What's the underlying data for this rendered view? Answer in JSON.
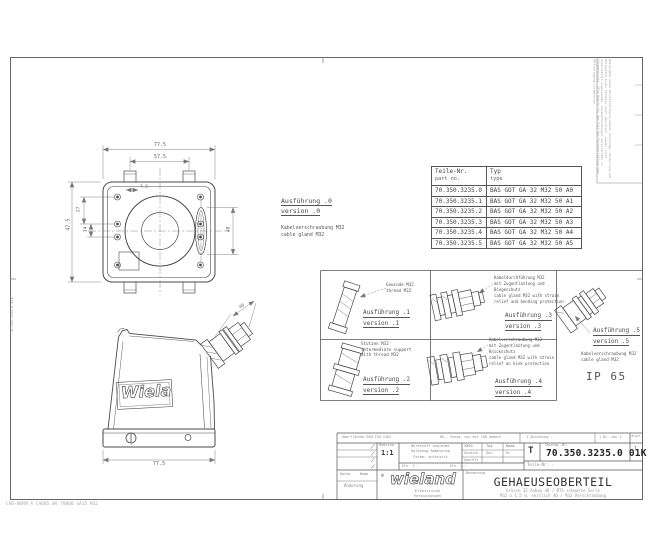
{
  "parts_table": {
    "header": {
      "part_no_de": "Teile-Nr.",
      "part_no_en": "part no.",
      "type_de": "Typ",
      "type_en": "type"
    },
    "rows": [
      {
        "part_no": "70.350.3235.0",
        "type": "BAS GOT GA 32 M32 50 A0"
      },
      {
        "part_no": "70.350.3235.1",
        "type": "BAS GOT GA 32 M32 50 A1"
      },
      {
        "part_no": "70.350.3235.2",
        "type": "BAS GOT GA 32 M32 50 A2"
      },
      {
        "part_no": "70.350.3235.3",
        "type": "BAS GOT GA 32 M32 50 A3"
      },
      {
        "part_no": "70.350.3235.4",
        "type": "BAS GOT GA 32 M32 50 A4"
      },
      {
        "part_no": "70.350.3235.5",
        "type": "BAS GOT GA 32 M32 50 A5"
      }
    ]
  },
  "versions": {
    "v0": {
      "title": "Ausführung .0",
      "subtitle": "version .0",
      "note1": "Kabelverschraubung M32",
      "note2": "cable gland M32"
    },
    "v1": {
      "title": "Ausführung .1",
      "subtitle": "version .1",
      "note1": "Gewinde M32",
      "note2": "thread M32"
    },
    "v2": {
      "title": "Ausführung .2",
      "subtitle": "version .2",
      "note1": "Stutzen M32",
      "note2": "intermediate support",
      "note3": "with thread M32"
    },
    "v3": {
      "title": "Ausführung .3",
      "subtitle": "version .3",
      "note1": "Kabeldurchführung M32",
      "note2": "mit Zugentlastung und",
      "note3": "Biegeschutz",
      "note4": "cable gland M32 with strain",
      "note5": "relief and bending protection"
    },
    "v4": {
      "title": "Ausführung .4",
      "subtitle": "version .4",
      "note1": "Kabelverschraubung M32",
      "note2": "mit Zugentlastung und",
      "note3": "Knickschutz",
      "note4": "cable gland M32 with strain",
      "note5": "relief an kink protection"
    },
    "v5": {
      "title": "Ausführung .5",
      "subtitle": "version .5",
      "note1": "Kabelverschraubung M32",
      "note2": "cable gland M32"
    }
  },
  "ip_rating": "IP 65",
  "side_logo": "Wielan",
  "dims": {
    "top_outer": "77.5",
    "top_inner": "57.5",
    "height": "47.5",
    "hole_a": "27",
    "hole_b": "14",
    "tab_offset": "7.5",
    "ellipse": "40",
    "side_width": "77.5",
    "gland_length": "40"
  },
  "title_block": {
    "note_left": "Oberflächen DIN ISO 1302",
    "note_mid": "DK - Zchng. nur mit CAD ändern",
    "note_r1": "1 Zeichnung  -",
    "note_r2": "1 Bl. von 1",
    "sheet_label": "Blatt",
    "sheet_value": "1",
    "scale_label": "Maßstab",
    "scale_value": "1:1",
    "material_lines": [
      "Werkstoff und/oder",
      "Halbzeug Abmessung",
      "Farbe: anthrazit"
    ],
    "sub_left": "Ers. f.:",
    "sub_right": "Ers. d.:",
    "approval": {
      "c1": "2003",
      "c2": "Tag",
      "c3": "Name",
      "r1a": "Gezeich.",
      "r1b": "Dez.",
      "r1c": "Rz",
      "r2a": "Geprüft",
      "r2b": "",
      "r2c": ""
    },
    "t_label": "T",
    "drawing_no_label": "Zeichng.-Nr.",
    "drawing_no": "70.350.3235.0 01K",
    "part_no_label": "Teile-Nr.  -",
    "benennung_label": "Benennung",
    "title": "GEHAEUSEOBERTEIL",
    "subtitle1": "Grösse 32 Anbau 40 / BTS schwarze Serie",
    "subtitle2": "M32 x 1,5 m. seitlich 40 / M32 Verschraubung",
    "rev_datum": "Datum",
    "rev_name": "Name",
    "rev_aenderung": "Änderung",
    "logo_r": "®",
    "logo": "wieland",
    "tagline1": "Elektrische",
    "tagline2": "Verbindungen"
  },
  "edge": {
    "left_vertical": "70.350.3235.0 01K",
    "copyright1": "Weitergabe sowie Vervielfältigung dieser Unterlage, Verwertung und Mitteilung ihres Inhaltes nicht gestattet, soweit nicht ausdrücklich zugestanden.",
    "copyright2": "Zuwiderhandlungen verpflichten zu Schadenersatz. Alle Rechte für den Fall der Patenterteilung oder GM-Eintragung vorbehalten.",
    "footer": "CAD-NORM_A CAD05 WV 70000 GA15 M32"
  },
  "colors": {
    "line": "#4a4a4a",
    "dim": "#777777",
    "text": "#555555"
  }
}
